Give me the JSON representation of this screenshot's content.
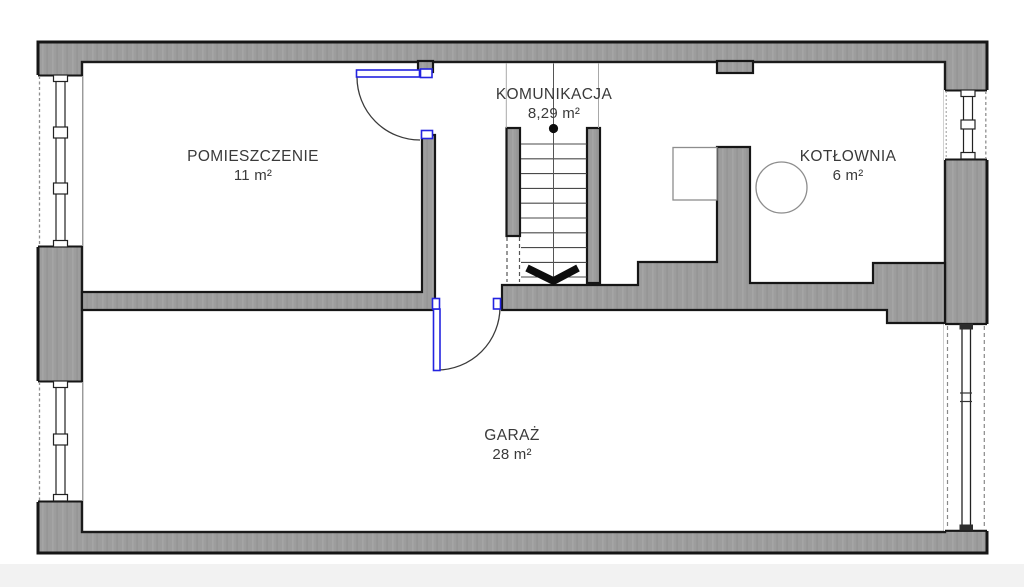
{
  "plan": {
    "rooms": [
      {
        "name": "POMIESZCZENIE",
        "area": "11 m²"
      },
      {
        "name": "KOMUNIKACJA",
        "area": "8,29 m²"
      },
      {
        "name": "KOTŁOWNIA",
        "area": "6 m²"
      },
      {
        "name": "GARAŻ",
        "area": "28 m²"
      }
    ],
    "colors": {
      "wall_fill": "#9d9d9d",
      "wall_outline": "#161616",
      "door": "#2323e0",
      "background": "#ffffff"
    }
  }
}
